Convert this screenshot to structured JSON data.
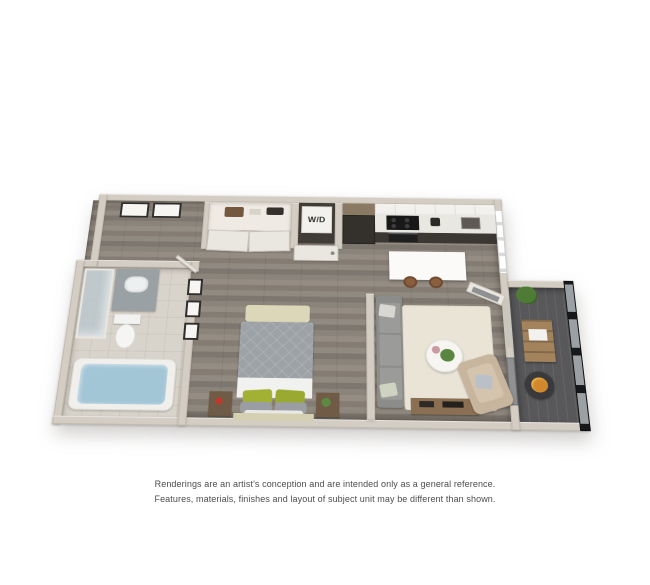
{
  "floorplan": {
    "wd_label": "W/D",
    "colors": {
      "background": "#ffffff",
      "wall": "#d3cdc3",
      "wood_floor": "#8c857c",
      "tile_floor": "#d9d4cb",
      "balcony_floor": "#58585a",
      "kitchen_cabinet_dark": "#34312d",
      "kitchen_counter": "#f0eeea",
      "island": "#fbfaf8",
      "bed_blanket": "#9da2a6",
      "pillow_green": "#a2b134",
      "sofa_gray": "#8c8c8a",
      "armchair_tan": "#c8b59d",
      "rug_cream": "#eae4d7",
      "tub_water": "#a3c6d6",
      "fire_bowl_orange": "#d2882c"
    }
  },
  "disclaimer": {
    "line1": "Renderings are an artist's conception and are intended only as a general reference.",
    "line2": "Features, materials, finishes and layout of subject unit may be different than shown."
  }
}
